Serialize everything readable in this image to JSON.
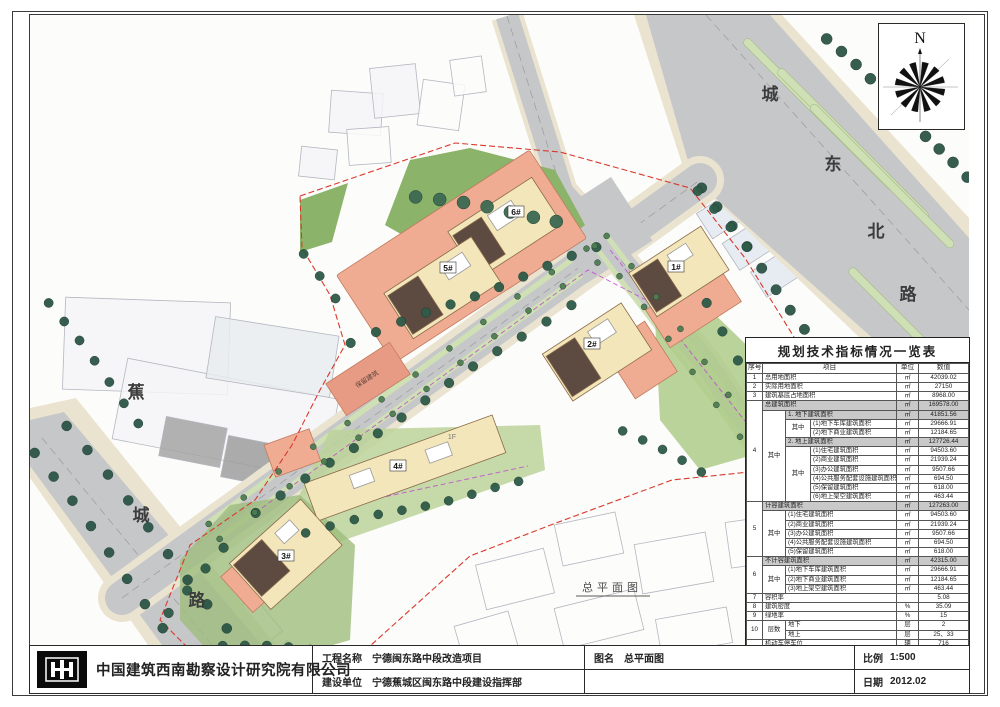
{
  "sheet": {
    "compass_label": "N",
    "caption": "总平面图",
    "plan": {
      "roads": [
        {
          "name": "城东北路"
        },
        {
          "name": "蕉城路"
        }
      ],
      "buildings": [
        {
          "label": "1#"
        },
        {
          "label": "2#"
        },
        {
          "label": "3#"
        },
        {
          "label": "4#"
        },
        {
          "label": "5#"
        },
        {
          "label": "6#"
        }
      ],
      "annotations": [
        {
          "text": "保留建筑"
        },
        {
          "text": "1F"
        }
      ]
    },
    "colors": {
      "road": "#c6c7c9",
      "sidewalk": "#eae3d0",
      "tree": "#2c5546",
      "lawn": "#8cb36a",
      "building_new": "#f3e6bb",
      "building_dark": "#5d4a40",
      "podium": "#efac92",
      "boundary_red": "#d9392c",
      "utility_magenta": "#c24fd0",
      "table_shade": "#c9c9c9"
    }
  },
  "table": {
    "title": "规划技术指标情况一览表",
    "headers": [
      "序号",
      "项目",
      "单位",
      "数值"
    ],
    "rows": [
      [
        {
          "t": "1"
        },
        {
          "t": "总用地面积",
          "cs": 3,
          "l": 1
        },
        {
          "t": "㎡"
        },
        {
          "t": "42039.02"
        }
      ],
      [
        {
          "t": "2"
        },
        {
          "t": "实际用地面积",
          "cs": 3,
          "l": 1
        },
        {
          "t": "㎡"
        },
        {
          "t": "27150"
        }
      ],
      [
        {
          "t": "3"
        },
        {
          "t": "建筑基底占地面积",
          "cs": 3,
          "l": 1
        },
        {
          "t": "㎡"
        },
        {
          "t": "8968.00"
        }
      ],
      [
        {
          "t": "4",
          "rs": 11
        },
        {
          "t": "总建筑面积",
          "cs": 3,
          "l": 1,
          "sh": 1
        },
        {
          "t": "㎡",
          "sh": 1
        },
        {
          "t": "169578.00",
          "sh": 1
        }
      ],
      [
        {
          "t": "其中",
          "rs": 10
        },
        {
          "t": "1. 地下建筑面积",
          "cs": 2,
          "l": 1,
          "sh": 1
        },
        {
          "t": "㎡",
          "sh": 1
        },
        {
          "t": "41851.56",
          "sh": 1
        }
      ],
      [
        {
          "t": "其中",
          "rs": 2
        },
        {
          "t": "(1)地下车库建筑面积",
          "l": 1
        },
        {
          "t": "㎡"
        },
        {
          "t": "29666.91"
        }
      ],
      [
        {
          "t": "(2)地下商业建筑面积",
          "l": 1
        },
        {
          "t": "㎡"
        },
        {
          "t": "12184.65"
        }
      ],
      [
        {
          "t": "2. 地上建筑面积",
          "cs": 2,
          "l": 1,
          "sh": 1
        },
        {
          "t": "㎡",
          "sh": 1
        },
        {
          "t": "127726.44",
          "sh": 1
        }
      ],
      [
        {
          "t": "其中",
          "rs": 6
        },
        {
          "t": "(1)住宅建筑面积",
          "l": 1
        },
        {
          "t": "㎡"
        },
        {
          "t": "94503.60"
        }
      ],
      [
        {
          "t": "(2)商业建筑面积",
          "l": 1
        },
        {
          "t": "㎡"
        },
        {
          "t": "21939.24"
        }
      ],
      [
        {
          "t": "(3)办公建筑面积",
          "l": 1
        },
        {
          "t": "㎡"
        },
        {
          "t": "9507.66"
        }
      ],
      [
        {
          "t": "(4)公共服务配套设施建筑面积",
          "l": 1
        },
        {
          "t": "㎡"
        },
        {
          "t": "694.50"
        }
      ],
      [
        {
          "t": "(5)保留建筑面积",
          "l": 1
        },
        {
          "t": "㎡"
        },
        {
          "t": "618.00"
        }
      ],
      [
        {
          "t": "(6)地上架空建筑面积",
          "l": 1
        },
        {
          "t": "㎡"
        },
        {
          "t": "463.44"
        }
      ],
      [
        {
          "t": "5",
          "rs": 6
        },
        {
          "t": "计容建筑面积",
          "cs": 3,
          "l": 1,
          "sh": 1
        },
        {
          "t": "㎡",
          "sh": 1
        },
        {
          "t": "127263.00",
          "sh": 1
        }
      ],
      [
        {
          "t": "其中",
          "rs": 5
        },
        {
          "t": "(1)住宅建筑面积",
          "cs": 2,
          "l": 1
        },
        {
          "t": "㎡"
        },
        {
          "t": "94503.60"
        }
      ],
      [
        {
          "t": "(2)商业建筑面积",
          "cs": 2,
          "l": 1
        },
        {
          "t": "㎡"
        },
        {
          "t": "21939.24"
        }
      ],
      [
        {
          "t": "(3)办公建筑面积",
          "cs": 2,
          "l": 1
        },
        {
          "t": "㎡"
        },
        {
          "t": "9507.66"
        }
      ],
      [
        {
          "t": "(4)公共服务配套设施建筑面积",
          "cs": 2,
          "l": 1
        },
        {
          "t": "㎡"
        },
        {
          "t": "694.50"
        }
      ],
      [
        {
          "t": "(5)保留建筑面积",
          "cs": 2,
          "l": 1
        },
        {
          "t": "㎡"
        },
        {
          "t": "618.00"
        }
      ],
      [
        {
          "t": "6",
          "rs": 4
        },
        {
          "t": "不计容建筑面积",
          "cs": 3,
          "l": 1,
          "sh": 1
        },
        {
          "t": "㎡",
          "sh": 1
        },
        {
          "t": "42315.00",
          "sh": 1
        }
      ],
      [
        {
          "t": "其中",
          "rs": 3
        },
        {
          "t": "(1)地下车库建筑面积",
          "cs": 2,
          "l": 1
        },
        {
          "t": "㎡"
        },
        {
          "t": "29666.91"
        }
      ],
      [
        {
          "t": "(2)地下商业建筑面积",
          "cs": 2,
          "l": 1
        },
        {
          "t": "㎡"
        },
        {
          "t": "12184.65"
        }
      ],
      [
        {
          "t": "(3)地上架空建筑面积",
          "cs": 2,
          "l": 1
        },
        {
          "t": "㎡"
        },
        {
          "t": "463.44"
        }
      ],
      [
        {
          "t": "7"
        },
        {
          "t": "容积率",
          "cs": 3,
          "l": 1
        },
        {
          "t": ""
        },
        {
          "t": "5.08"
        }
      ],
      [
        {
          "t": "8"
        },
        {
          "t": "建筑密度",
          "cs": 3,
          "l": 1
        },
        {
          "t": "%"
        },
        {
          "t": "35.09"
        }
      ],
      [
        {
          "t": "9"
        },
        {
          "t": "绿地率",
          "cs": 3,
          "l": 1
        },
        {
          "t": "%"
        },
        {
          "t": "15"
        }
      ],
      [
        {
          "t": "10",
          "rs": 2
        },
        {
          "t": "层数",
          "rs": 2
        },
        {
          "t": "地下",
          "cs": 2,
          "l": 1
        },
        {
          "t": "层"
        },
        {
          "t": "2"
        }
      ],
      [
        {
          "t": "地上",
          "cs": 2,
          "l": 1
        },
        {
          "t": "层"
        },
        {
          "t": "25、33"
        }
      ],
      [
        {
          "t": "11",
          "rs": 3
        },
        {
          "t": "机动车停车位",
          "cs": 3,
          "l": 1
        },
        {
          "t": "辆"
        },
        {
          "t": "716"
        }
      ],
      [
        {
          "t": "其中",
          "rs": 2
        },
        {
          "t": "1.地上",
          "cs": 2,
          "l": 1
        },
        {
          "t": "辆"
        },
        {
          "t": "51"
        }
      ],
      [
        {
          "t": "2.地下",
          "cs": 2,
          "l": 1
        },
        {
          "t": "辆"
        },
        {
          "t": "665"
        }
      ],
      [
        {
          "t": "12"
        },
        {
          "t": "户数",
          "cs": 3,
          "l": 1
        },
        {
          "t": "户"
        },
        {
          "t": "869"
        }
      ],
      [
        {
          "t": ""
        },
        {
          "t": "",
          "cs": 3
        },
        {
          "t": ""
        },
        {
          "t": ""
        }
      ]
    ]
  },
  "titleblock": {
    "company": "中国建筑西南勘察设计研究院有限公司",
    "project_label": "工程名称",
    "project_value": "宁德闽东路中段改造项目",
    "client_label": "建设单位",
    "client_value": "宁德蕉城区闽东路中段建设指挥部",
    "drawing_label": "图名",
    "drawing_value": "总平面图",
    "scale_label": "比例",
    "scale_value": "1:500",
    "date_label": "日期",
    "date_value": "2012.02"
  }
}
